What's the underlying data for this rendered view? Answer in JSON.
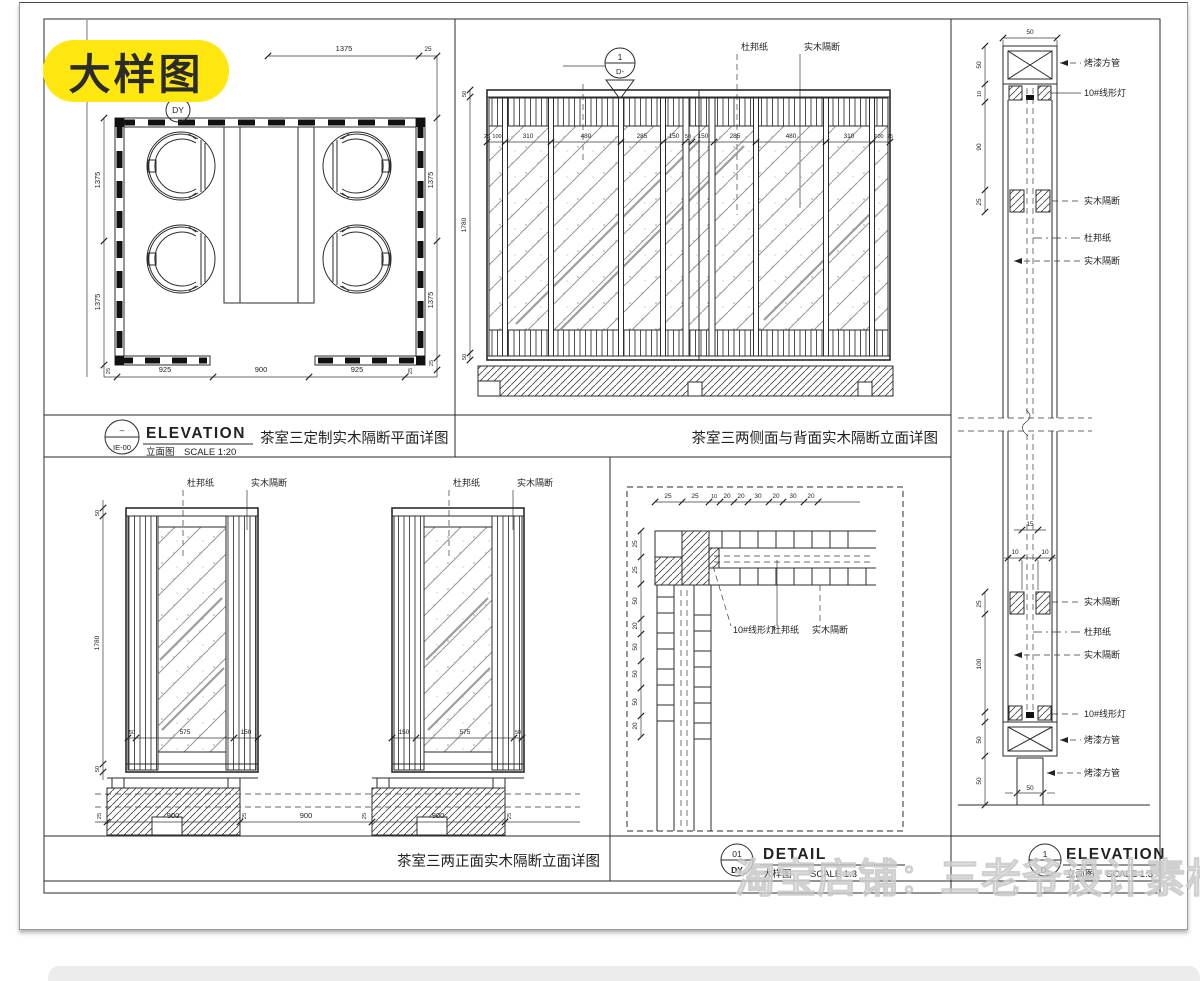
{
  "badge": {
    "label": "大样图"
  },
  "watermark": {
    "text": "淘宝店铺：三老爷设计素材基地"
  },
  "colors": {
    "badge_bg": "#ffe70f",
    "line": "#2b2b2b",
    "watermark": "#e3e3e3"
  },
  "materials": {
    "dupont": "杜邦纸",
    "wood_partition": "实木隔断",
    "linear_light": "10#线形灯",
    "painted_tube": "烤漆方管"
  },
  "plan": {
    "marker": "DY",
    "dim_top": [
      "1375",
      "25"
    ],
    "dim_left": [
      "1375",
      "1375"
    ],
    "dim_right": [
      "1375",
      "1375",
      "25"
    ],
    "dim_bottom": [
      "925",
      "900",
      "925"
    ],
    "dim_small": "25"
  },
  "band": {
    "ref_dash": "–",
    "ref_code": "IE-00",
    "elevation_en": "ELEVATION",
    "elevation_cn": "立面图",
    "scale": "SCALE 1:20",
    "plan_title": "茶室三定制实木隔断平面详图",
    "back_title": "茶室三两侧面与背面实木隔断立面详图"
  },
  "elev_back": {
    "marker_top": "1",
    "marker_bottom": "D-",
    "dim_left": [
      "50",
      "1780",
      "50"
    ],
    "dim_mid": [
      "25",
      "100",
      "310",
      "480",
      "285",
      "150",
      "50",
      "150",
      "285",
      "480",
      "310",
      "100",
      "25"
    ]
  },
  "elev_front": {
    "title": "茶室三两正面实木隔断立面详图",
    "dim_left": [
      "50",
      "1780",
      "50"
    ],
    "dim_inner_left": [
      "50",
      "575",
      "150"
    ],
    "dim_inner_right": [
      "150",
      "575",
      "50"
    ],
    "dim_bottom": [
      "900",
      "900",
      "900"
    ],
    "dim_small": "25"
  },
  "detail": {
    "dim_top": [
      "25",
      "25",
      "10",
      "20",
      "20",
      "30",
      "20",
      "30",
      "20"
    ],
    "dim_left": [
      "25",
      "25",
      "50",
      "20",
      "50",
      "50",
      "50",
      "20"
    ],
    "ref_num": "01",
    "ref_code": "DY",
    "title_en": "DETAIL",
    "title_cn": "大样图",
    "scale": "SCALE 1:3"
  },
  "section": {
    "dim_top": "50",
    "dim_upper": [
      "50",
      "10",
      "90",
      "25"
    ],
    "dim_core": [
      "15",
      "10",
      "10"
    ],
    "dim_mid": "25",
    "dim_lower": [
      "100",
      "50",
      "50"
    ],
    "dim_bottom": "50",
    "ref_num": "1",
    "ref_code": "D-",
    "title_en": "ELEVATION",
    "title_cn": "立面图",
    "scale": "SCALE 1:3"
  }
}
